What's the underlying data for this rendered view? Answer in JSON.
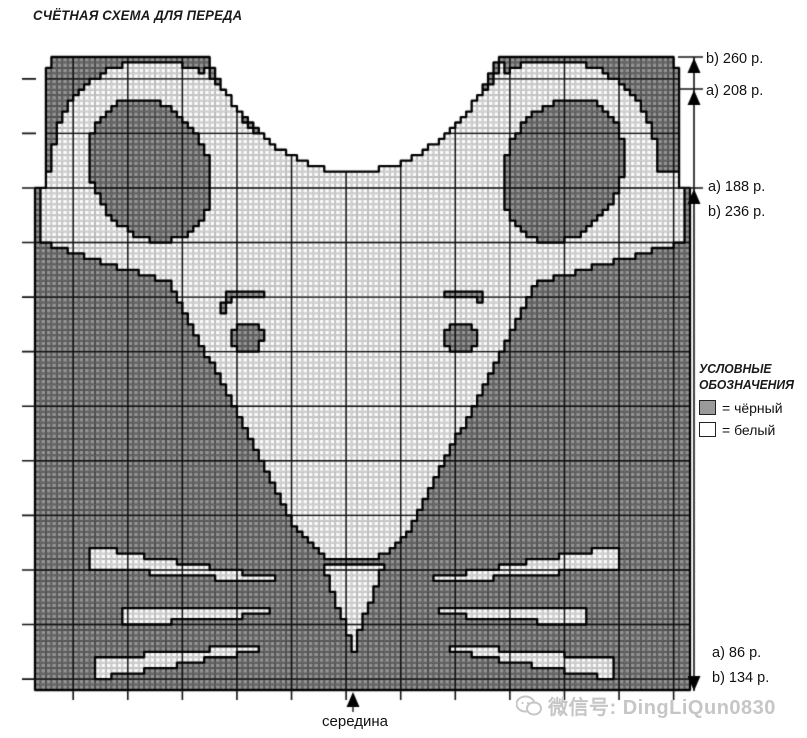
{
  "title": "СЧЁТНАЯ СХЕМА ДЛЯ ПЕРЕДА",
  "annotations": {
    "top_right": [
      {
        "label": "b) 260 р."
      },
      {
        "label": "a) 208 р."
      }
    ],
    "armhole_right": [
      {
        "label": "a) 188 р."
      },
      {
        "label": "b) 236 р."
      }
    ],
    "bottom_right": [
      {
        "label": "a) 86 р."
      },
      {
        "label": "b) 134 р."
      }
    ],
    "bottom_center": "середина"
  },
  "legend": {
    "title_line1": "УСЛОВНЫЕ",
    "title_line2": "ОБОЗНАЧЕНИЯ",
    "items": [
      {
        "symbol": "dark-square",
        "label": "= чёрный"
      },
      {
        "symbol": "white-square",
        "label": "= белый"
      }
    ]
  },
  "watermark": {
    "icon": "wechat-icon",
    "text": "微信号: DingLiQun0830"
  },
  "chart_data": {
    "type": "heatmap",
    "description": "Counted knitting colorwork chart for the front of a sweater depicting a mouse face; gray squares = black yarn, white squares = white yarn.",
    "grid": {
      "x0": 35,
      "y0": 57,
      "x1": 690,
      "y1": 690,
      "cols": 120,
      "rows": 116
    },
    "bold": {
      "every": 10,
      "col_offset": 7,
      "row_offset": 4
    },
    "ticks": {
      "left_len": 13,
      "bottom_len": 10
    },
    "measure": {
      "x": 694,
      "top": 57,
      "bottom": 691,
      "cross_ticks": [
        57,
        89,
        188
      ],
      "up_arrows": [
        58,
        90,
        189
      ],
      "down_arrow_tip": 691
    },
    "center_arrow": {
      "x": 353,
      "tip_y": 692,
      "len": 20
    },
    "colors": {
      "dark": "#949494",
      "white": "#fbfbfb",
      "grid_on_dark": "#474747",
      "grid_on_white": "#b4b4b4",
      "bold_line": "#111111",
      "outline": "#000000",
      "page_bg": "#ffffff",
      "watermark": "#c6c6c6"
    },
    "silhouette": {
      "left": 35,
      "right": 690,
      "top": 57,
      "bottom": 690,
      "armhole_y": 188,
      "armhole_inset": 11,
      "shoulder_y": 70,
      "shoulder_inset": 17,
      "neck": {
        "cx": 353.5,
        "half_width": 143.5,
        "top_y": 57,
        "depth": 115,
        "power": 0.75
      }
    },
    "shapes": [
      {
        "name": "left-ear-white",
        "color": "white",
        "kind": "ellipse",
        "cx": 152,
        "cy": 163,
        "rx": 100,
        "ry": 103
      },
      {
        "name": "right-ear-white",
        "color": "white",
        "kind": "ellipse",
        "cx": 555,
        "cy": 163,
        "rx": 102,
        "ry": 103
      },
      {
        "name": "collar-white",
        "color": "white",
        "kind": "collar",
        "cx": 353.5,
        "half_width": 150,
        "top_y": 57,
        "depth": 115,
        "power": 0.75,
        "down_to": 176
      },
      {
        "name": "face-white",
        "color": "white",
        "kind": "poly",
        "points": [
          [
            40,
            172
          ],
          [
            684,
            172
          ],
          [
            684,
            242
          ],
          [
            537,
            283
          ],
          [
            407,
            535
          ],
          [
            380,
            557
          ],
          [
            327,
            557
          ],
          [
            300,
            535
          ],
          [
            170,
            283
          ],
          [
            40,
            242
          ]
        ]
      },
      {
        "name": "left-ear-inner-dark",
        "color": "dark",
        "kind": "rotellipse",
        "cx": 150,
        "cy": 170,
        "rx": 58,
        "ry": 74,
        "rot": -25
      },
      {
        "name": "right-ear-inner-dark",
        "color": "dark",
        "kind": "rotellipse",
        "cx": 563,
        "cy": 170,
        "rx": 58,
        "ry": 74,
        "rot": 25
      },
      {
        "name": "left-eyebrow-hook",
        "color": "dark",
        "kind": "strip",
        "x1": 222,
        "y1": 309,
        "w1": 9,
        "x2": 229,
        "y2": 295,
        "w2": 9
      },
      {
        "name": "left-eyebrow-bar",
        "color": "dark",
        "kind": "strip",
        "x1": 226,
        "y1": 294,
        "w1": 9,
        "x2": 263,
        "y2": 294,
        "w2": 9
      },
      {
        "name": "right-eyebrow-bar",
        "color": "dark",
        "kind": "strip",
        "x1": 444,
        "y1": 294,
        "w1": 9,
        "x2": 481,
        "y2": 294,
        "w2": 9
      },
      {
        "name": "right-eyebrow-hook",
        "color": "dark",
        "kind": "strip",
        "x1": 478,
        "y1": 295,
        "w1": 9,
        "x2": 485,
        "y2": 309,
        "w2": 9
      },
      {
        "name": "left-eye",
        "color": "dark",
        "kind": "ellipse",
        "cx": 247,
        "cy": 337,
        "rx": 16,
        "ry": 15
      },
      {
        "name": "right-eye",
        "color": "dark",
        "kind": "ellipse",
        "cx": 460,
        "cy": 337,
        "rx": 16,
        "ry": 15
      },
      {
        "name": "nose-white",
        "color": "white",
        "kind": "poly",
        "points": [
          [
            323,
            562
          ],
          [
            385,
            562
          ],
          [
            357,
            638
          ],
          [
            357,
            652
          ],
          [
            349,
            652
          ],
          [
            349,
            638
          ]
        ]
      },
      {
        "name": "whisker-left-top",
        "color": "white",
        "kind": "strip",
        "x1": 90,
        "y1": 557,
        "w1": 21,
        "x2": 275,
        "y2": 581,
        "w2": 5
      },
      {
        "name": "whisker-left-middle",
        "color": "white",
        "kind": "strip",
        "x1": 121,
        "y1": 616,
        "w1": 19,
        "x2": 267,
        "y2": 612,
        "w2": 5
      },
      {
        "name": "whisker-left-bottom",
        "color": "white",
        "kind": "strip",
        "x1": 94,
        "y1": 669,
        "w1": 21,
        "x2": 258,
        "y2": 648,
        "w2": 6
      },
      {
        "name": "whisker-right-top",
        "color": "white",
        "kind": "strip",
        "x1": 617,
        "y1": 557,
        "w1": 21,
        "x2": 432,
        "y2": 581,
        "w2": 5
      },
      {
        "name": "whisker-right-middle",
        "color": "white",
        "kind": "strip",
        "x1": 586,
        "y1": 616,
        "w1": 19,
        "x2": 440,
        "y2": 612,
        "w2": 5
      },
      {
        "name": "whisker-right-bottom",
        "color": "white",
        "kind": "strip",
        "x1": 613,
        "y1": 669,
        "w1": 21,
        "x2": 449,
        "y2": 648,
        "w2": 6
      }
    ]
  }
}
